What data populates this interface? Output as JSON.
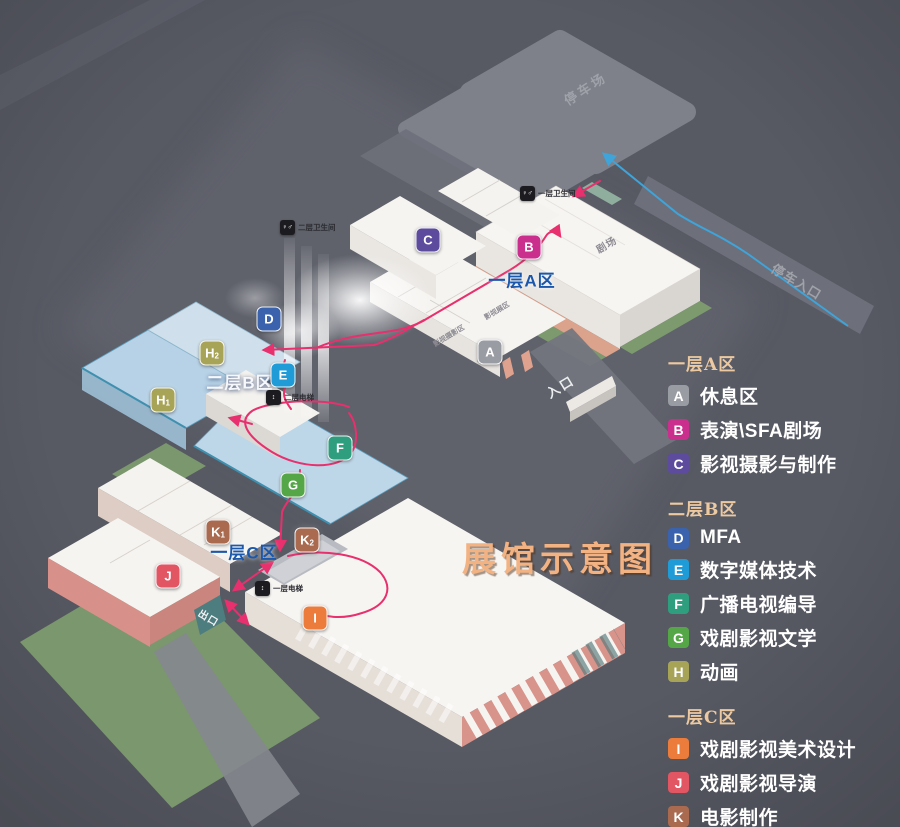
{
  "title": {
    "text": "展馆示意图"
  },
  "colors": {
    "background": "#575963",
    "walk_route": "#e7306d",
    "car_route": "#3ea4d9",
    "title": "#f3b282",
    "legend_header": "#ecc9a1",
    "area_label_blue": "#1b58ac"
  },
  "legend": {
    "sections": [
      {
        "header": "一层A区",
        "items": [
          {
            "key": "A",
            "label": "休息区",
            "style": {
              "background": "#9a9ca4"
            }
          },
          {
            "key": "B",
            "label": "表演\\SFA剧场",
            "style": {
              "background": "#cb2f8d"
            }
          },
          {
            "key": "C",
            "label": "影视摄影与制作",
            "style": {
              "background": "#5d4b9e"
            }
          }
        ]
      },
      {
        "header": "二层B区",
        "items": [
          {
            "key": "D",
            "label": "MFA",
            "style": {
              "background": "#3a62ad"
            }
          },
          {
            "key": "E",
            "label": "数字媒体技术",
            "style": {
              "background": "#1f9cd8"
            }
          },
          {
            "key": "F",
            "label": "广播电视编导",
            "style": {
              "background": "#2e9e7e"
            }
          },
          {
            "key": "G",
            "label": "戏剧影视文学",
            "style": {
              "background": "#55a647"
            }
          },
          {
            "key": "H",
            "label": "动画",
            "style": {
              "background": "#a8a457"
            }
          }
        ]
      },
      {
        "header": "一层C区",
        "items": [
          {
            "key": "I",
            "label": "戏剧影视美术设计",
            "style": {
              "background": "#ec7c3c"
            }
          },
          {
            "key": "J",
            "label": "戏剧影视导演",
            "style": {
              "background": "#e25563"
            }
          },
          {
            "key": "K",
            "label": "电影制作",
            "style": {
              "background": "#aa6a4f"
            }
          }
        ]
      }
    ]
  },
  "map": {
    "area_labels": [
      {
        "text": "一层A区",
        "style": {
          "left": 522,
          "top": 279,
          "color": "#1b58ac",
          "text-shadow": "0 0 5px rgba(255,255,255,.85)"
        }
      },
      {
        "text": "二层B区",
        "style": {
          "left": 240,
          "top": 381,
          "color": "#f6f8fb",
          "text-shadow": "0 1px 4px rgba(20,40,90,.8)"
        }
      },
      {
        "text": "一层C区",
        "style": {
          "left": 244,
          "top": 551,
          "color": "#1b58ac",
          "text-shadow": "0 0 5px rgba(255,255,255,.85)"
        }
      }
    ],
    "markers": [
      {
        "key": "A",
        "sub": "",
        "style": {
          "left": 490,
          "top": 352,
          "background": "#9a9ca4"
        }
      },
      {
        "key": "B",
        "sub": "",
        "style": {
          "left": 529,
          "top": 247,
          "background": "#cb2f8d"
        }
      },
      {
        "key": "C",
        "sub": "",
        "style": {
          "left": 428,
          "top": 240,
          "background": "#5d4b9e"
        }
      },
      {
        "key": "D",
        "sub": "",
        "style": {
          "left": 269,
          "top": 319,
          "background": "#3a62ad"
        }
      },
      {
        "key": "E",
        "sub": "",
        "style": {
          "left": 283,
          "top": 375,
          "background": "#1f9cd8"
        }
      },
      {
        "key": "F",
        "sub": "",
        "style": {
          "left": 340,
          "top": 448,
          "background": "#2e9e7e"
        }
      },
      {
        "key": "G",
        "sub": "",
        "style": {
          "left": 293,
          "top": 485,
          "background": "#55a647"
        }
      },
      {
        "key": "H",
        "sub": "1",
        "style": {
          "left": 163,
          "top": 400,
          "background": "#a8a457"
        }
      },
      {
        "key": "H",
        "sub": "2",
        "style": {
          "left": 212,
          "top": 353,
          "background": "#a8a457"
        }
      },
      {
        "key": "I",
        "sub": "",
        "style": {
          "left": 315,
          "top": 618,
          "background": "#ec7c3c"
        }
      },
      {
        "key": "J",
        "sub": "",
        "style": {
          "left": 168,
          "top": 576,
          "background": "#e25563"
        }
      },
      {
        "key": "K",
        "sub": "1",
        "style": {
          "left": 218,
          "top": 532,
          "background": "#aa6a4f"
        }
      },
      {
        "key": "K",
        "sub": "2",
        "style": {
          "left": 307,
          "top": 540,
          "background": "#aa6a4f"
        }
      }
    ],
    "place_labels": [
      {
        "text": "停车场",
        "style": {
          "left": 585,
          "top": 88,
          "font-size": 13,
          "letter-spacing": 3,
          "color": "#a0a2aa",
          "transform": "translate(-50%,-50%) rotate(-33deg)"
        }
      },
      {
        "text": "停车入口",
        "style": {
          "left": 797,
          "top": 281,
          "font-size": 13,
          "letter-spacing": 1,
          "color": "#a0a2aa",
          "transform": "translate(-50%,-50%) rotate(31deg)"
        }
      },
      {
        "text": "入口",
        "style": {
          "left": 560,
          "top": 386,
          "font-size": 13,
          "letter-spacing": 2,
          "color": "#eceef0",
          "transform": "translate(-50%,-50%) rotate(-31deg)"
        }
      },
      {
        "text": "出口",
        "style": {
          "left": 209,
          "top": 617,
          "font-size": 10,
          "letter-spacing": 1,
          "color": "#f3f3f5",
          "transform": "translate(-50%,-50%) rotate(31deg)"
        }
      },
      {
        "text": "剧场",
        "style": {
          "left": 606,
          "top": 244,
          "font-size": 10,
          "letter-spacing": 1,
          "color": "#8e8b93",
          "transform": "translate(-50%,-50%) rotate(-31deg)"
        }
      },
      {
        "text": "影视展区",
        "style": {
          "left": 497,
          "top": 311,
          "font-size": 7,
          "color": "#8e8b93",
          "transform": "translate(-50%,-50%) rotate(-31deg)"
        }
      },
      {
        "text": "休息区",
        "style": {
          "left": 487,
          "top": 357,
          "font-size": 7,
          "color": "#8e8b93",
          "transform": "translate(-50%,-50%) rotate(-31deg)"
        }
      },
      {
        "text": "影视摄影区",
        "style": {
          "left": 449,
          "top": 336,
          "font-size": 7,
          "color": "#8e8b93",
          "transform": "translate(-50%,-50%) rotate(-31deg)"
        }
      }
    ],
    "facilities": [
      {
        "icon": "restroom-icon",
        "glyph": "♀♂",
        "label": "一层卫生间",
        "style": {
          "left": 520,
          "top": 186
        }
      },
      {
        "icon": "restroom-icon",
        "glyph": "♀♂",
        "label": "二层卫生间",
        "style": {
          "left": 280,
          "top": 220
        }
      },
      {
        "icon": "elevator-icon",
        "glyph": "↕",
        "label": "二层电梯",
        "style": {
          "left": 266,
          "top": 390
        }
      },
      {
        "icon": "elevator-icon",
        "glyph": "↕",
        "label": "一层电梯",
        "style": {
          "left": 255,
          "top": 581
        }
      }
    ]
  }
}
